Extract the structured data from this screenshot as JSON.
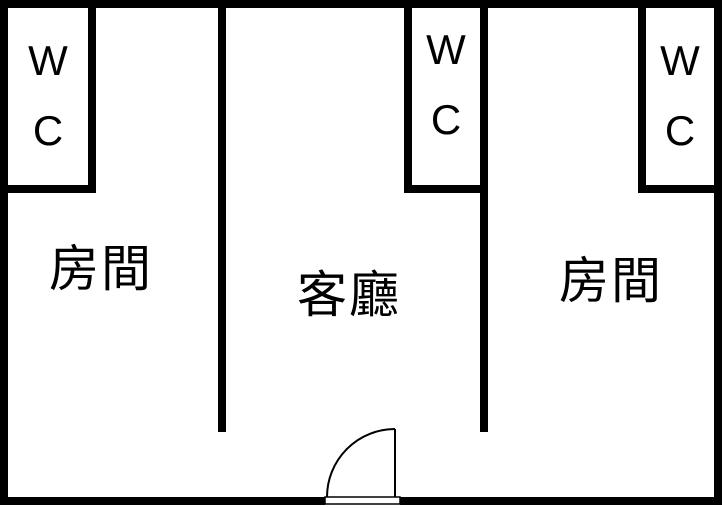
{
  "floorplan": {
    "rooms": {
      "bedroom_left": {
        "label": "房間"
      },
      "living_room": {
        "label": "客廳"
      },
      "bedroom_right": {
        "label": "房間"
      }
    },
    "wc_label": {
      "line1": "W",
      "line2": "C"
    },
    "colors": {
      "wall": "#000000",
      "floor": "#ffffff"
    }
  }
}
